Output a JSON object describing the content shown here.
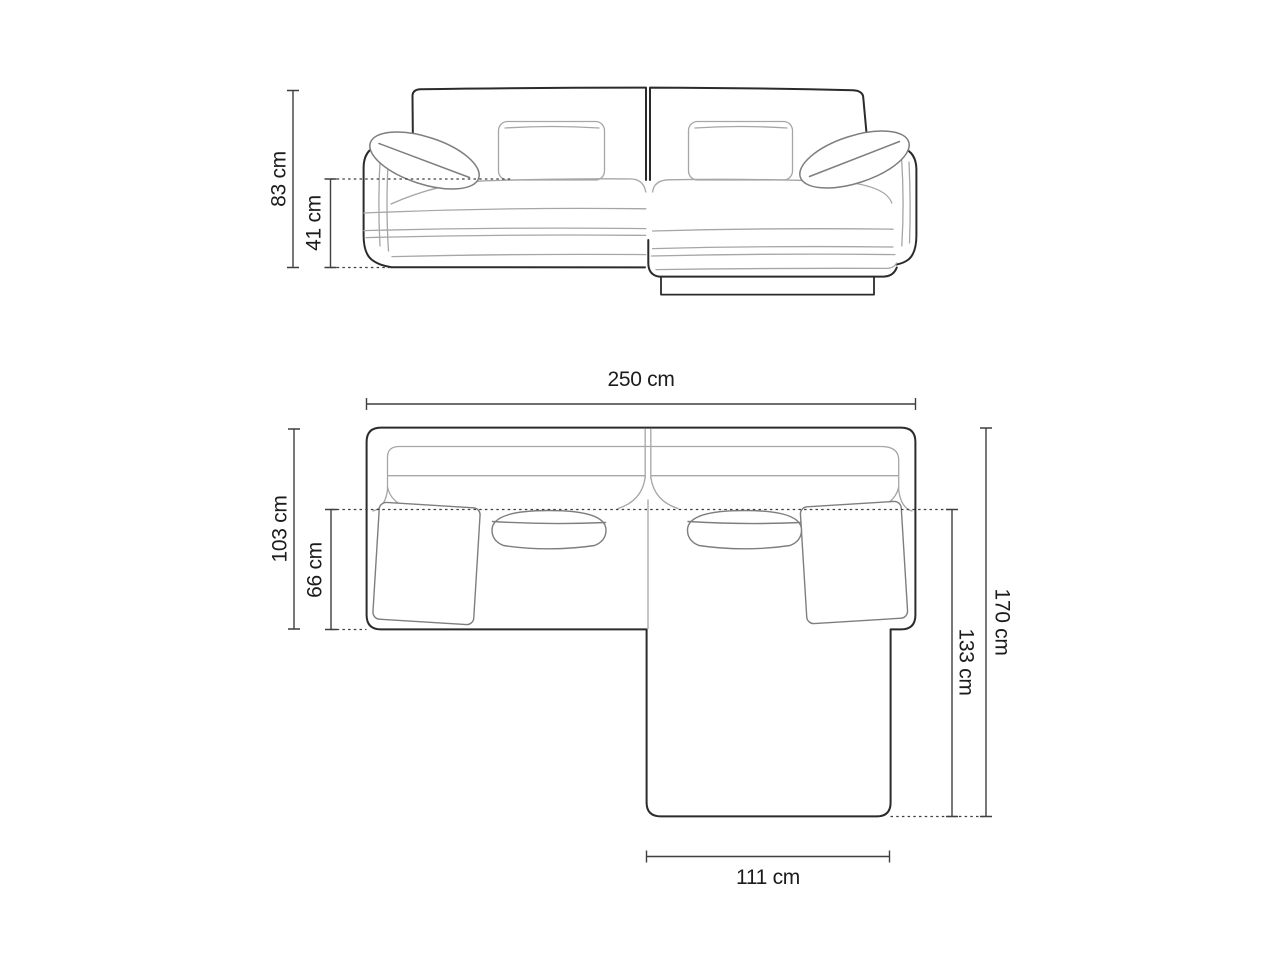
{
  "labels": {
    "height_total": "83 cm",
    "seat_height": "41 cm",
    "width_total": "250 cm",
    "body_depth": "103 cm",
    "seat_depth": "66 cm",
    "total_depth": "170 cm",
    "chaise_depth": "133 cm",
    "chaise_width": "111 cm"
  },
  "dimensions_cm": {
    "height_total": 83,
    "seat_height": 41,
    "width_total": 250,
    "body_depth": 103,
    "seat_depth": 66,
    "total_depth": 170,
    "chaise_depth": 133,
    "chaise_width": 111
  },
  "colors": {
    "background": "#ffffff",
    "outline_dark": "#2b2b2b",
    "outline_light": "#a6a6a6",
    "outline_medium": "#7e7e7e",
    "dimension_line": "#3f3f3f",
    "label_text": "#1c1c1c"
  }
}
